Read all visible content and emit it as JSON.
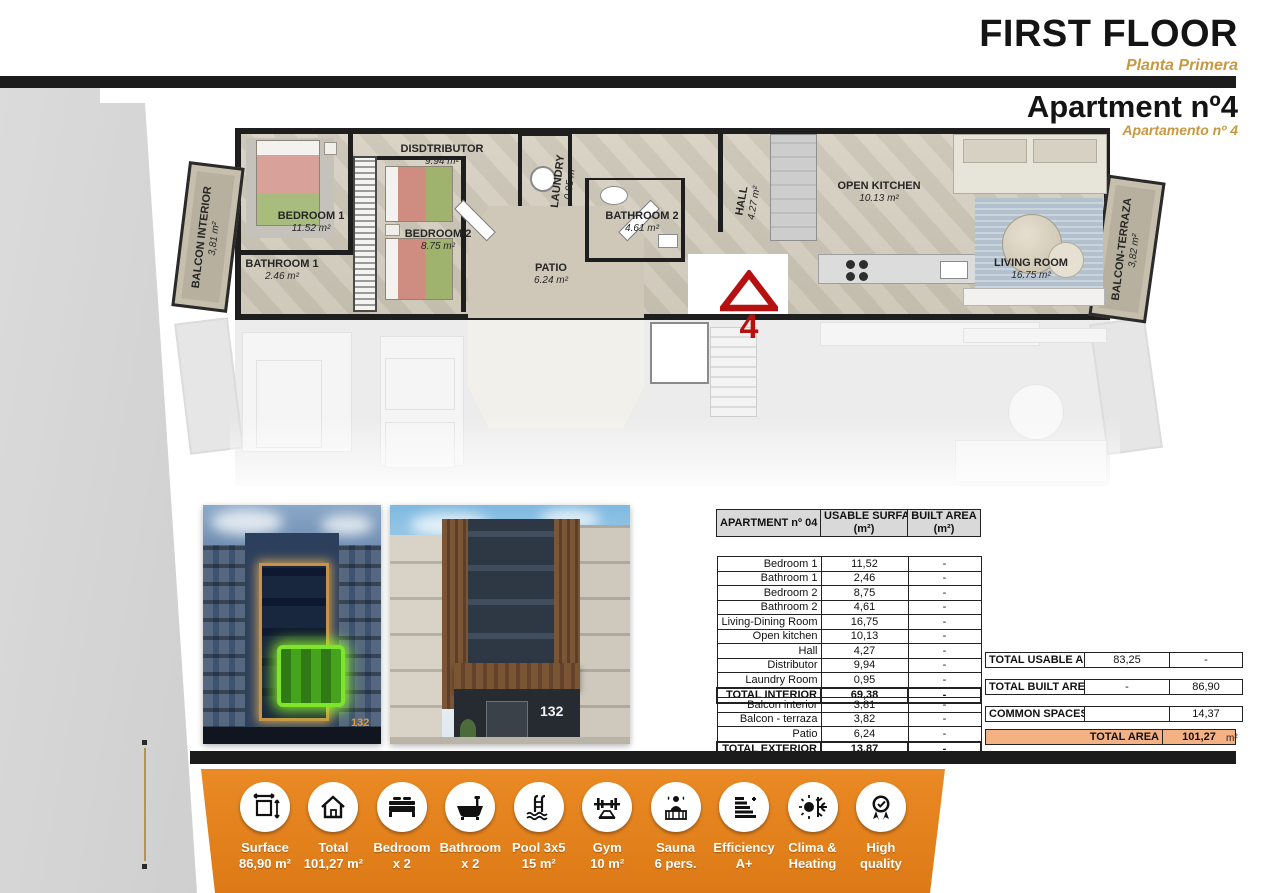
{
  "header": {
    "floor_title": "FIRST FLOOR",
    "floor_subtitle": "Planta Primera",
    "apartment_title": "Apartment nº4",
    "apartment_subtitle": "Apartamento nº 4"
  },
  "plan": {
    "unit_marker": "4",
    "rooms": [
      {
        "name": "BALCON INTERIOR",
        "area": "3,81 m²"
      },
      {
        "name": "BEDROOM 1",
        "area": "11.52 m²"
      },
      {
        "name": "BATHROOM 1",
        "area": "2.46 m²"
      },
      {
        "name": "DISDTRIBUTOR",
        "area": "9.94 m²"
      },
      {
        "name": "BEDROOM 2",
        "area": "8.75 m²"
      },
      {
        "name": "LAUNDRY",
        "area": "0.95 m²"
      },
      {
        "name": "PATIO",
        "area": "6.24 m²"
      },
      {
        "name": "BATHROOM 2",
        "area": "4.61 m²"
      },
      {
        "name": "HALL",
        "area": "4.27 m²"
      },
      {
        "name": "OPEN KITCHEN",
        "area": "10.13 m²"
      },
      {
        "name": "LIVING ROOM",
        "area": "16.75 m²"
      },
      {
        "name": "BALCON-TERRAZA",
        "area": "3,82 m²"
      }
    ]
  },
  "photos": [
    {
      "number": "132"
    },
    {
      "number": "132"
    }
  ],
  "table": {
    "col1": "APARTMENT nº 04",
    "col2a": "USABLE SURFACE",
    "col2b": "(m²)",
    "col3a": "BUILT AREA",
    "col3b": "(m²)",
    "interior": [
      {
        "label": "Bedroom 1",
        "usable": "11,52",
        "built": "-"
      },
      {
        "label": "Bathroom 1",
        "usable": "2,46",
        "built": "-"
      },
      {
        "label": "Bedroom 2",
        "usable": "8,75",
        "built": "-"
      },
      {
        "label": "Bathroom 2",
        "usable": "4,61",
        "built": "-"
      },
      {
        "label": "Living-Dining Room",
        "usable": "16,75",
        "built": "-"
      },
      {
        "label": "Open kitchen",
        "usable": "10,13",
        "built": "-"
      },
      {
        "label": "Hall",
        "usable": "4,27",
        "built": "-"
      },
      {
        "label": "Distributor",
        "usable": "9,94",
        "built": "-"
      },
      {
        "label": "Laundry Room",
        "usable": "0,95",
        "built": "-"
      },
      {
        "label": "TOTAL INTERIOR",
        "usable": "69,38",
        "built": "-"
      }
    ],
    "exterior": [
      {
        "label": "Balcon interior",
        "usable": "3,81",
        "built": "-"
      },
      {
        "label": "Balcon - terraza",
        "usable": "3,82",
        "built": "-"
      },
      {
        "label": "Patio",
        "usable": "6,24",
        "built": "-"
      },
      {
        "label": "TOTAL EXTERIOR",
        "usable": "13,87",
        "built": "-"
      }
    ]
  },
  "totals": {
    "usable": {
      "label": "TOTAL USABLE AREA",
      "usable": "83,25",
      "built": "-"
    },
    "built": {
      "label": "TOTAL BUILT AREA",
      "usable": "-",
      "built": "86,90"
    },
    "common": {
      "label": "COMMON SPACES",
      "usable": "",
      "built": "14,37"
    },
    "total": {
      "label": "TOTAL AREA",
      "value": "101,27",
      "unit": "m²"
    }
  },
  "amenities": [
    {
      "line1": "Surface",
      "line2": "86,90 m²"
    },
    {
      "line1": "Total",
      "line2": "101,27 m²"
    },
    {
      "line1": "Bedroom",
      "line2": "x 2"
    },
    {
      "line1": "Bathroom",
      "line2": "x 2"
    },
    {
      "line1": "Pool 3x5",
      "line2": "15 m²"
    },
    {
      "line1": "Gym",
      "line2": "10 m²"
    },
    {
      "line1": "Sauna",
      "line2": "6 pers."
    },
    {
      "line1": "Efficiency",
      "line2": "A+"
    },
    {
      "line1": "Clima &",
      "line2": "Heating"
    },
    {
      "line1": "High",
      "line2": "quality"
    }
  ],
  "colors": {
    "accent_orange": "#e5821c",
    "gold_text": "#c9983e",
    "total_row_fill": "#f4b183",
    "logo_red": "#b51111"
  }
}
